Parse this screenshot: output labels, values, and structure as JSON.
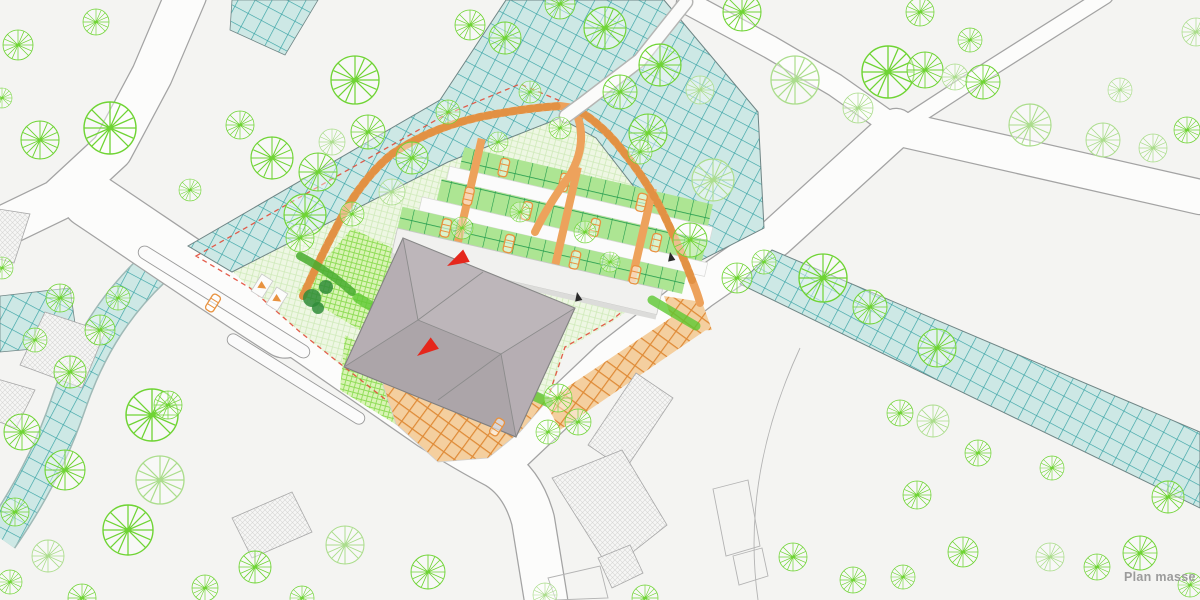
{
  "page": {
    "label": "Plan masse",
    "label_color": "#9b9b9b",
    "background": "#f4f4f2"
  },
  "map": {
    "type": "architectural-site-plan",
    "colors": {
      "tree_bright": "#6fd434",
      "tree_pale": "#abdd8c",
      "shrub_dark": "#2f8c38",
      "water_fill": "#cde8e5",
      "water_grid": "#36a2a4",
      "site_hatch": "#cfeab9",
      "lawn_bright": "#8fdc57",
      "stall_line": "#1f9a4b",
      "path_orange": "#eda25c",
      "plaza_line": "#df8a36",
      "roof_gray": "#b6aeb3",
      "red_accent": "#e5271c",
      "boundary_red": "#e14b38",
      "car_orange": "#e8923f",
      "arrow_black": "#2a2a2a"
    },
    "trees": [
      [
        18,
        45,
        15,
        "b"
      ],
      [
        96,
        22,
        13,
        "b"
      ],
      [
        110,
        128,
        26,
        "b"
      ],
      [
        40,
        140,
        19,
        "b"
      ],
      [
        2,
        98,
        10,
        "b"
      ],
      [
        355,
        80,
        24,
        "b"
      ],
      [
        305,
        215,
        21,
        "b"
      ],
      [
        190,
        190,
        11,
        "b"
      ],
      [
        240,
        125,
        14,
        "b"
      ],
      [
        272,
        158,
        21,
        "b"
      ],
      [
        318,
        172,
        19,
        "b"
      ],
      [
        332,
        142,
        13,
        "p"
      ],
      [
        368,
        132,
        17,
        "b"
      ],
      [
        300,
        238,
        14,
        "b"
      ],
      [
        412,
        158,
        16,
        "b"
      ],
      [
        392,
        192,
        13,
        "p"
      ],
      [
        352,
        214,
        12,
        "b"
      ],
      [
        2,
        268,
        11,
        "b"
      ],
      [
        60,
        298,
        14,
        "b"
      ],
      [
        100,
        330,
        15,
        "b"
      ],
      [
        70,
        372,
        16,
        "b"
      ],
      [
        35,
        340,
        12,
        "b"
      ],
      [
        118,
        298,
        12,
        "b"
      ],
      [
        152,
        415,
        26,
        "b"
      ],
      [
        128,
        530,
        25,
        "b"
      ],
      [
        65,
        470,
        20,
        "b"
      ],
      [
        22,
        432,
        18,
        "b"
      ],
      [
        15,
        512,
        14,
        "b"
      ],
      [
        48,
        556,
        16,
        "p"
      ],
      [
        10,
        582,
        12,
        "b"
      ],
      [
        82,
        598,
        14,
        "b"
      ],
      [
        160,
        480,
        24,
        "p"
      ],
      [
        205,
        588,
        13,
        "b"
      ],
      [
        255,
        567,
        16,
        "b"
      ],
      [
        345,
        545,
        19,
        "p"
      ],
      [
        428,
        572,
        17,
        "b"
      ],
      [
        302,
        598,
        12,
        "b"
      ],
      [
        470,
        25,
        15,
        "b"
      ],
      [
        505,
        38,
        16,
        "b"
      ],
      [
        560,
        4,
        15,
        "b"
      ],
      [
        605,
        28,
        21,
        "b"
      ],
      [
        660,
        65,
        21,
        "b"
      ],
      [
        620,
        92,
        17,
        "b"
      ],
      [
        742,
        12,
        19,
        "b"
      ],
      [
        700,
        90,
        14,
        "p"
      ],
      [
        795,
        80,
        24,
        "p"
      ],
      [
        858,
        108,
        15,
        "p"
      ],
      [
        888,
        72,
        26,
        "b"
      ],
      [
        925,
        70,
        18,
        "b"
      ],
      [
        955,
        77,
        13,
        "p"
      ],
      [
        983,
        82,
        17,
        "b"
      ],
      [
        920,
        12,
        14,
        "b"
      ],
      [
        970,
        40,
        12,
        "b"
      ],
      [
        1030,
        125,
        21,
        "p"
      ],
      [
        1103,
        140,
        17,
        "p"
      ],
      [
        1153,
        148,
        14,
        "p"
      ],
      [
        1187,
        130,
        13,
        "b"
      ],
      [
        1196,
        32,
        14,
        "p"
      ],
      [
        1120,
        90,
        12,
        "p"
      ],
      [
        648,
        133,
        19,
        "b"
      ],
      [
        713,
        180,
        21,
        "p"
      ],
      [
        690,
        240,
        17,
        "b"
      ],
      [
        737,
        278,
        15,
        "b"
      ],
      [
        764,
        262,
        12,
        "b"
      ],
      [
        823,
        278,
        24,
        "b"
      ],
      [
        870,
        307,
        17,
        "b"
      ],
      [
        937,
        348,
        19,
        "b"
      ],
      [
        978,
        453,
        13,
        "b"
      ],
      [
        1052,
        468,
        12,
        "b"
      ],
      [
        900,
        413,
        13,
        "b"
      ],
      [
        933,
        421,
        16,
        "p"
      ],
      [
        1168,
        497,
        16,
        "b"
      ],
      [
        1140,
        553,
        17,
        "b"
      ],
      [
        1097,
        567,
        13,
        "b"
      ],
      [
        1050,
        557,
        14,
        "p"
      ],
      [
        917,
        495,
        14,
        "b"
      ],
      [
        963,
        552,
        15,
        "b"
      ],
      [
        853,
        580,
        13,
        "b"
      ],
      [
        793,
        557,
        14,
        "b"
      ],
      [
        903,
        577,
        12,
        "b"
      ],
      [
        1190,
        585,
        12,
        "b"
      ],
      [
        558,
        398,
        14,
        "b"
      ],
      [
        578,
        422,
        13,
        "b"
      ],
      [
        548,
        432,
        12,
        "b"
      ],
      [
        498,
        142,
        10,
        "b"
      ],
      [
        560,
        128,
        11,
        "b"
      ],
      [
        640,
        152,
        12,
        "b"
      ],
      [
        520,
        212,
        10,
        "b"
      ],
      [
        585,
        232,
        11,
        "b"
      ],
      [
        462,
        228,
        11,
        "b"
      ],
      [
        610,
        262,
        10,
        "b"
      ],
      [
        448,
        112,
        12,
        "b"
      ],
      [
        530,
        92,
        11,
        "b"
      ],
      [
        545,
        595,
        12,
        "p"
      ],
      [
        645,
        598,
        13,
        "b"
      ],
      [
        168,
        405,
        14,
        "b"
      ]
    ],
    "shrubs": [
      [
        312,
        298,
        9
      ],
      [
        326,
        287,
        7
      ],
      [
        318,
        308,
        6
      ]
    ],
    "parking_cars_local": [
      [
        498,
        181
      ],
      [
        560,
        182
      ],
      [
        640,
        184
      ],
      [
        470,
        217
      ],
      [
        530,
        218
      ],
      [
        600,
        219
      ],
      [
        663,
        220
      ],
      [
        455,
        253
      ],
      [
        520,
        254
      ],
      [
        588,
        255
      ],
      [
        650,
        256
      ]
    ],
    "road_cars": [
      {
        "x": 213,
        "y": 303,
        "a": 122
      },
      {
        "x": 497,
        "y": 427,
        "a": 122
      }
    ],
    "red_arrows": [
      {
        "x": 447,
        "y": 266,
        "a": -28
      },
      {
        "x": 417,
        "y": 356,
        "a": -36
      }
    ],
    "black_arrows": [
      {
        "x": 577,
        "y": 292,
        "a": 35
      },
      {
        "x": 670,
        "y": 252,
        "a": 35
      }
    ],
    "stall_arrows": [
      {
        "x": 262,
        "y": 286,
        "a": 122
      },
      {
        "x": 277,
        "y": 299,
        "a": 122
      }
    ]
  }
}
